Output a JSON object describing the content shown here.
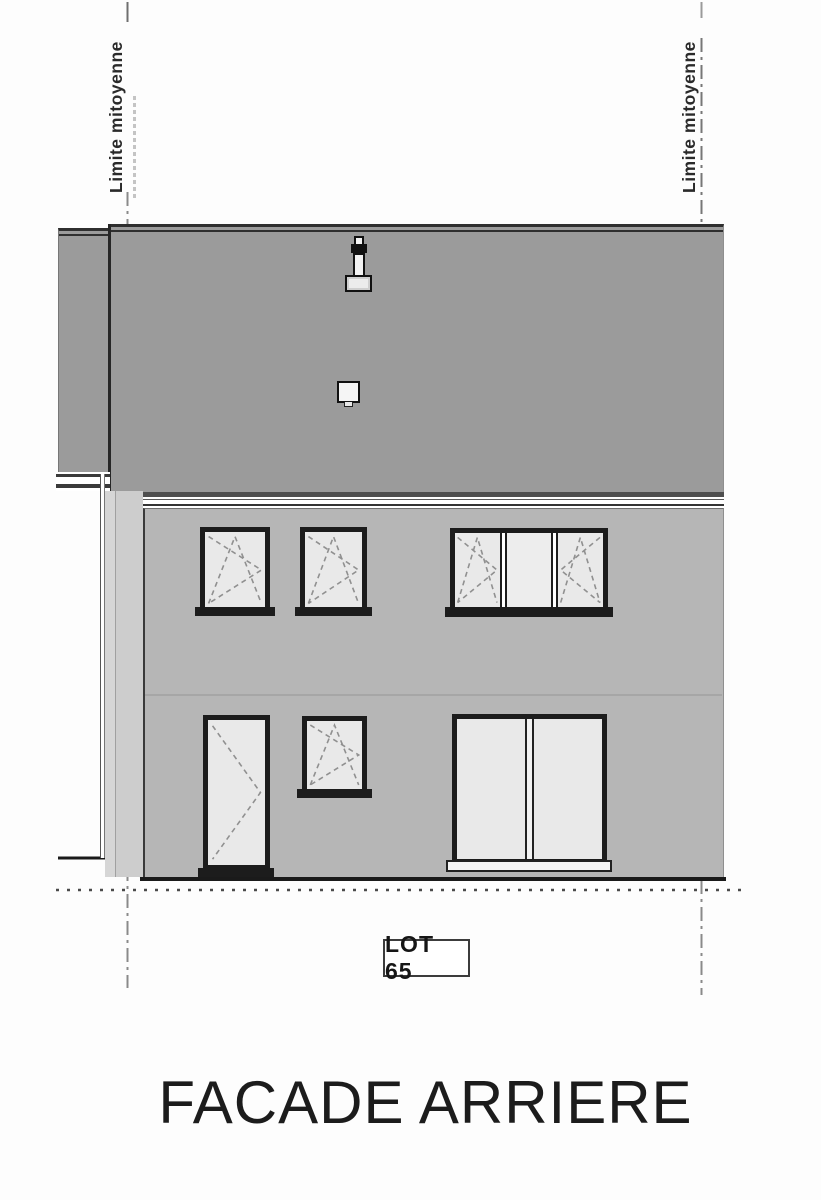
{
  "title": {
    "text": "FACADE ARRIERE"
  },
  "lot_label": {
    "text": "LOT 65"
  },
  "boundaries": {
    "left_label": "Limite mitoyenne",
    "right_label": "Limite mitoyenne"
  },
  "drawing": {
    "type": "architectural_elevation",
    "subject": "rear facade of a two-storey attached house",
    "lot_number": "65",
    "upper_floor_openings": [
      "small tilt-turn window",
      "small tilt-turn window",
      "triple window with fixed centre pane"
    ],
    "ground_floor_openings": [
      "glazed single door",
      "small tilt-turn window",
      "large double window"
    ],
    "roof_features": [
      "flue pipe with cap",
      "roof vent box"
    ]
  },
  "colors": {
    "roof": "#9b9b9b",
    "wall": "#b6b6b6",
    "side_strip": "#cdcdcd",
    "glass": "#e9e9e9",
    "frame": "#1c1c1c",
    "line_dark": "#1a1a1a",
    "boundary": "#808080",
    "dash": "#909090",
    "paper": "#fdfdfd",
    "ink": "#1c1c1c"
  }
}
